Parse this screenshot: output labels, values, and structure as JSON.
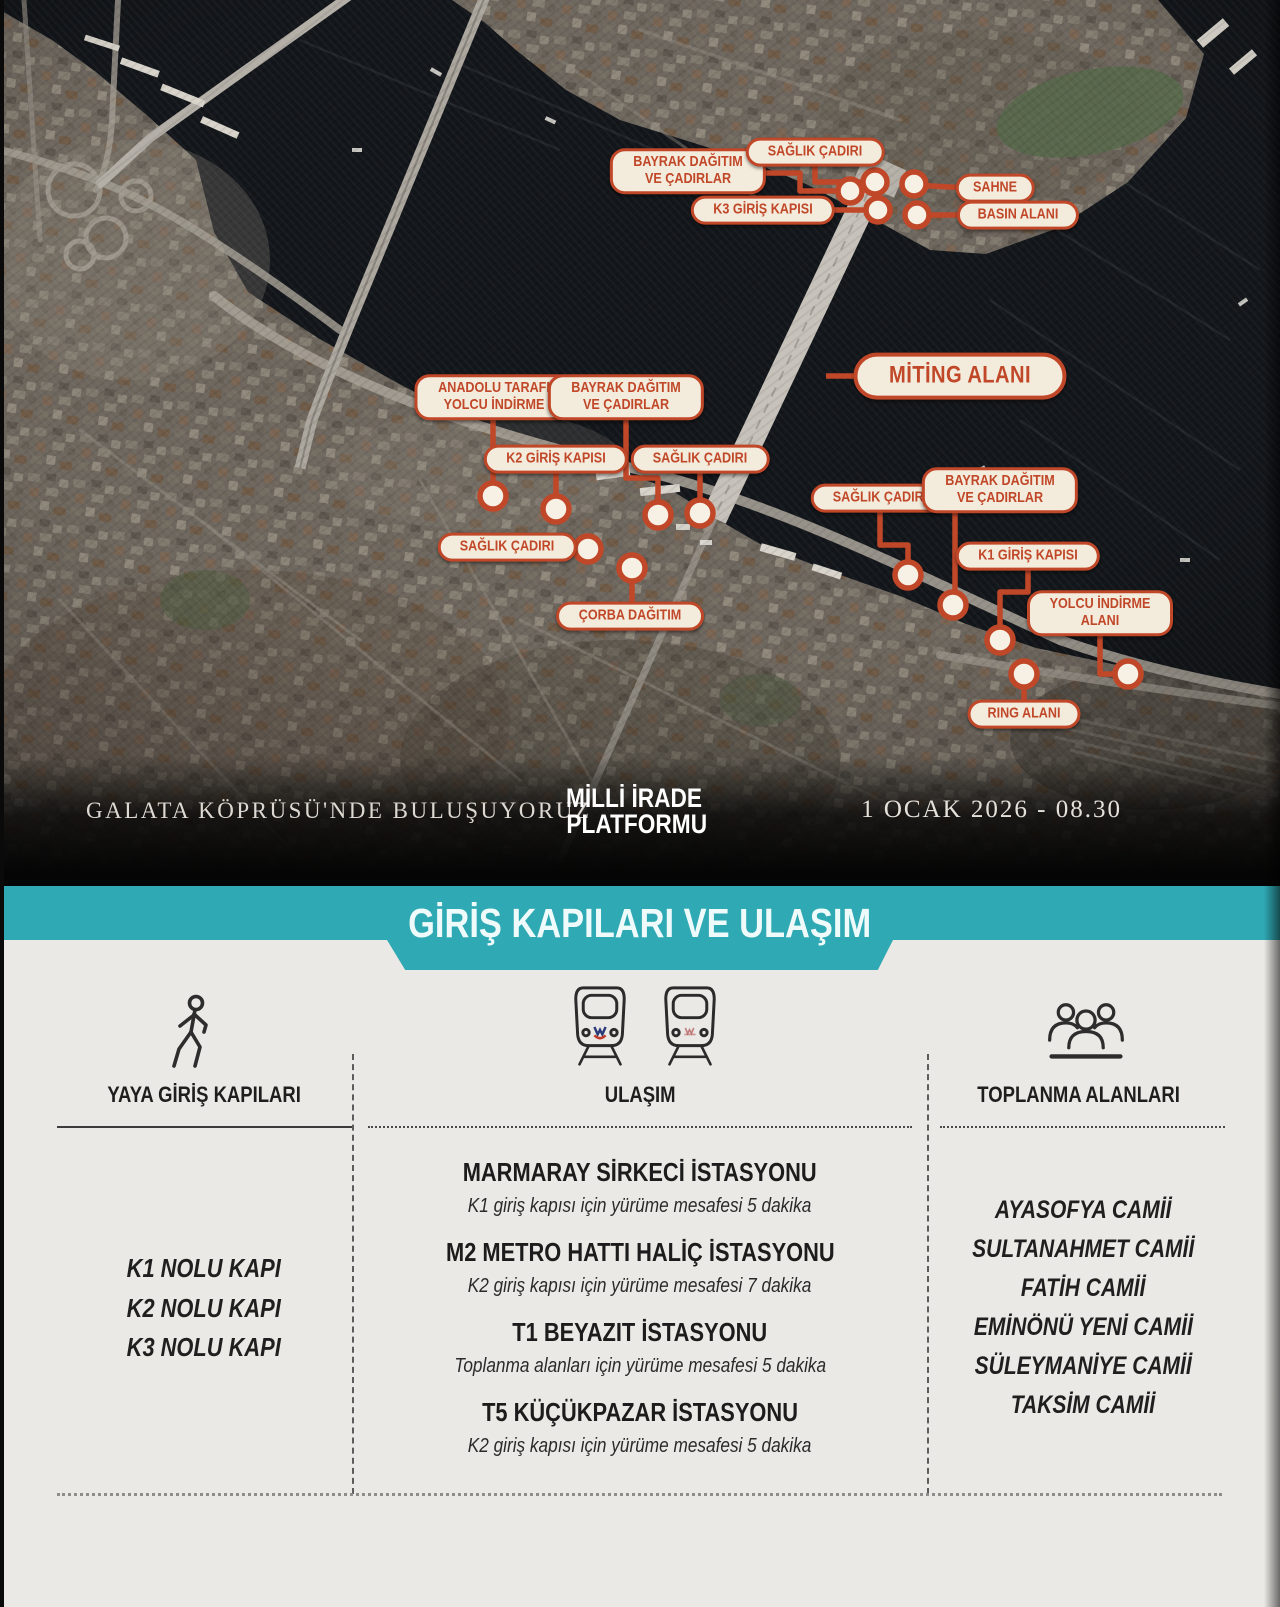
{
  "colors": {
    "accent_orange": "#c14729",
    "pill_bg": "#f3ecdc",
    "teal": "#2fa9b3",
    "section_bg": "#ebe9e5",
    "water": "#13161a"
  },
  "map": {
    "callouts": [
      {
        "x": 688,
        "y": 171,
        "lines": [
          "BAYRAK DAĞITIM",
          "VE ÇADIRLAR"
        ]
      },
      {
        "x": 815,
        "y": 152,
        "lines": [
          "SAĞLIK ÇADIRI"
        ]
      },
      {
        "x": 763,
        "y": 210,
        "lines": [
          "K3 GİRİŞ KAPISI"
        ]
      },
      {
        "x": 995,
        "y": 188,
        "lines": [
          "SAHNE"
        ]
      },
      {
        "x": 1018,
        "y": 215,
        "lines": [
          "BASIN ALANI"
        ]
      },
      {
        "x": 494,
        "y": 397,
        "lines": [
          "ANADOLU TARAFI",
          "YOLCU İNDİRME"
        ]
      },
      {
        "x": 626,
        "y": 397,
        "lines": [
          "BAYRAK DAĞITIM",
          "VE ÇADIRLAR"
        ]
      },
      {
        "x": 556,
        "y": 459,
        "lines": [
          "K2 GİRİŞ KAPISI"
        ]
      },
      {
        "x": 700,
        "y": 459,
        "lines": [
          "SAĞLIK ÇADIRI"
        ]
      },
      {
        "x": 960,
        "y": 376,
        "lines": [
          "MİTİNG ALANI"
        ],
        "big": true
      },
      {
        "x": 507,
        "y": 547,
        "lines": [
          "SAĞLIK ÇADIRI"
        ]
      },
      {
        "x": 630,
        "y": 616,
        "lines": [
          "ÇORBA DAĞITIM"
        ]
      },
      {
        "x": 880,
        "y": 498,
        "lines": [
          "SAĞLIK ÇADIRI"
        ]
      },
      {
        "x": 1000,
        "y": 490,
        "lines": [
          "BAYRAK DAĞITIM",
          "VE ÇADIRLAR"
        ]
      },
      {
        "x": 1028,
        "y": 556,
        "lines": [
          "K1 GİRİŞ KAPISI"
        ]
      },
      {
        "x": 1100,
        "y": 613,
        "lines": [
          "YOLCU İNDİRME",
          "ALANI"
        ]
      },
      {
        "x": 1024,
        "y": 714,
        "lines": [
          "RING ALANI"
        ]
      }
    ],
    "caption": {
      "meet_text": "GALATA KÖPRÜSÜ'NDE  BULUŞUYORUZ",
      "logo_line1": "MİLLİ İRADE",
      "logo_line2": "PLATFORMU",
      "datetime": "1 OCAK 2026 - 08.30"
    }
  },
  "banner": {
    "title": "GİRİŞ KAPILARI VE ULAŞIM"
  },
  "sections": {
    "gates": {
      "header": "YAYA GİRİŞ KAPILARI",
      "items": [
        "K1 NOLU KAPI",
        "K2 NOLU KAPI",
        "K3 NOLU KAPI"
      ]
    },
    "transport": {
      "header": "ULAŞIM",
      "stations": [
        {
          "name": "MARMARAY SİRKECİ İSTASYONU",
          "detail": "K1  giriş kapısı için yürüme mesafesi 5 dakika"
        },
        {
          "name": "M2 METRO HATTI HALİÇ İSTASYONU",
          "detail": "K2 giriş kapısı için yürüme mesafesi 7 dakika"
        },
        {
          "name": "T1 BEYAZIT İSTASYONU",
          "detail": "Toplanma alanları için yürüme mesafesi 5 dakika"
        },
        {
          "name": "T5 KÜÇÜKPAZAR İSTASYONU",
          "detail": "K2 giriş kapısı için yürüme mesafesi 5 dakika"
        }
      ]
    },
    "gathering": {
      "header": "TOPLANMA ALANLARI",
      "items": [
        "AYASOFYA CAMİİ",
        "SULTANAHMET CAMİİ",
        "FATİH CAMİİ",
        "EMİNÖNÜ YENİ CAMİİ",
        "SÜLEYMANİYE CAMİİ",
        "TAKSİM CAMİİ"
      ]
    }
  }
}
